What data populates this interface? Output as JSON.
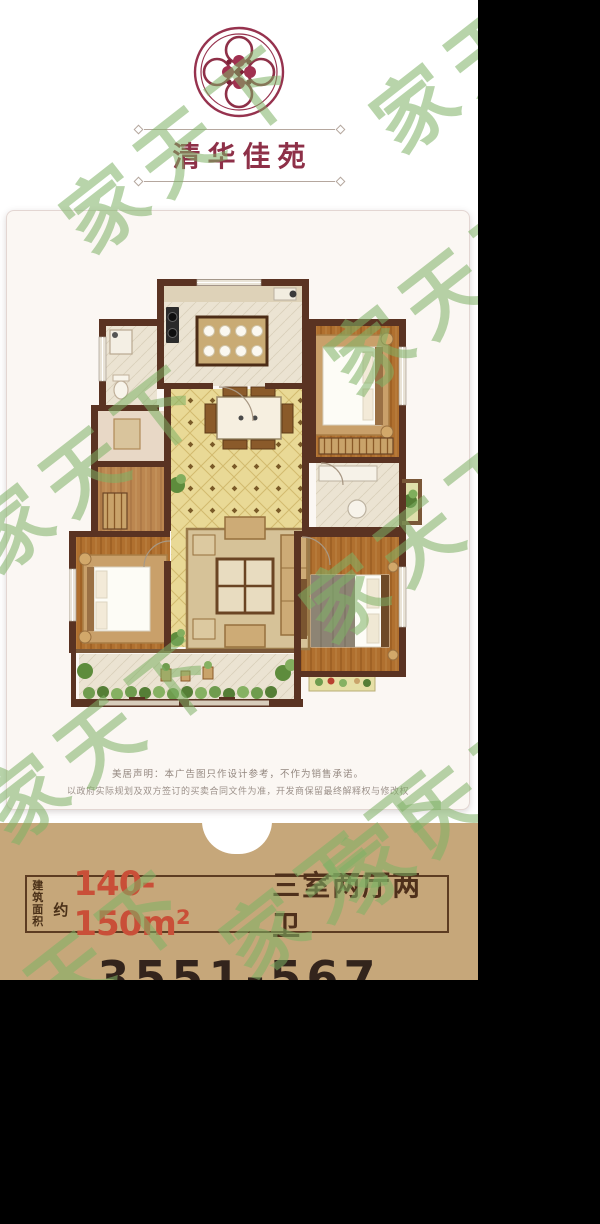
{
  "brand": {
    "name": "清华佳苑"
  },
  "watermark": {
    "text": "家天下"
  },
  "disclaimer": {
    "line1": "美居声明：本广告图只作设计参考，不作为销售承诺。",
    "line2": "以政府实际规划及双方签订的买卖合同文件为准，开发商保留最终解释权与修改权"
  },
  "footer": {
    "area_label_line1": "建筑",
    "area_label_line2": "面积",
    "approx": "约",
    "area_value": "140-150m²",
    "layout_text": "三室两厅两卫",
    "phone_partial": "3551-567"
  },
  "floor_plan": {
    "rooms": [
      "kitchen",
      "dining-room",
      "living-room",
      "bedroom-top-right",
      "master-bedroom",
      "bedroom-bottom-right",
      "bathroom-top-left",
      "storage-room",
      "bathroom-right",
      "balcony",
      "planter"
    ]
  },
  "colors": {
    "background": "#000000",
    "photo_bg": "#ffffff",
    "card_bg": "#fbf7f3",
    "footer_bg": "#c6a77a",
    "accent_red": "#c94f38",
    "text_brown": "#553620",
    "brand_maroon": "#8e3048",
    "watermark_green": "#7fb266",
    "wall": "#5a3322",
    "wood": "#b0702f",
    "tile_yellow": "#e9d996",
    "tile_light": "#ebe3d2"
  }
}
